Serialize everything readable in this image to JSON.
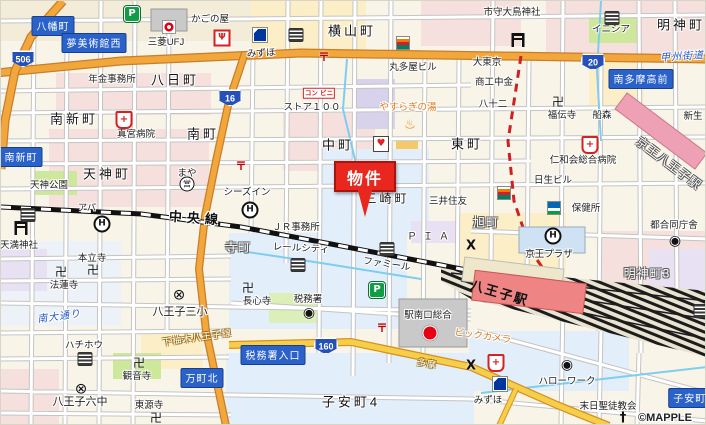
{
  "map": {
    "marker": {
      "label": "物件"
    },
    "copyright": "©MAPPLE",
    "colors": {
      "road_major": "#f2a73d",
      "road_secondary": "#f6cf4a",
      "sign_bg": "#2b62c9",
      "marker_red": "#e8281e",
      "rail_black": "#111111",
      "station_pink": "#ee8484",
      "water": "#7ecdf0"
    },
    "shields": [
      {
        "n": "route-shield-506",
        "route": "506",
        "x": 22,
        "y": 58
      },
      {
        "n": "route-shield-16",
        "route": "16",
        "x": 229,
        "y": 97
      },
      {
        "n": "route-shield-20",
        "route": "20",
        "x": 592,
        "y": 61
      },
      {
        "n": "route-shield-160",
        "route": "160",
        "x": 325,
        "y": 345
      }
    ],
    "labels": [
      {
        "n": "sign-hachimancho",
        "text": "八幡町",
        "x": 52,
        "y": 25,
        "cls": "sign"
      },
      {
        "n": "sign-yume-bijutsukan-nishi",
        "text": "夢美術館西",
        "x": 93,
        "y": 42,
        "cls": "sign"
      },
      {
        "n": "sign-minami-shincho",
        "text": "南新町",
        "x": 20,
        "y": 156,
        "cls": "sign"
      },
      {
        "n": "sign-minami-tama-ko-mae",
        "text": "南多摩高前",
        "x": 640,
        "y": 78,
        "cls": "sign"
      },
      {
        "n": "sign-mancho-kita",
        "text": "万町北",
        "x": 201,
        "y": 377,
        "cls": "sign"
      },
      {
        "n": "sign-zeimusho-iriguchi",
        "text": "税務署入口",
        "x": 272,
        "y": 354,
        "cls": "sign"
      },
      {
        "n": "sign-koyasucho",
        "text": "子安町4",
        "x": 692,
        "y": 397,
        "cls": "sign"
      },
      {
        "n": "town-yokamachi",
        "text": "八日町",
        "x": 174,
        "y": 78,
        "cls": "town"
      },
      {
        "n": "town-yokoyamacho",
        "text": "横山町",
        "x": 351,
        "y": 29,
        "cls": "town"
      },
      {
        "n": "town-myojincho",
        "text": "明神町",
        "x": 680,
        "y": 23,
        "cls": "town"
      },
      {
        "n": "town-minami-shincho",
        "text": "南新町",
        "x": 73,
        "y": 117,
        "cls": "town"
      },
      {
        "n": "town-minamicho",
        "text": "南町",
        "x": 202,
        "y": 132,
        "cls": "town"
      },
      {
        "n": "town-nakacho",
        "text": "中町",
        "x": 337,
        "y": 143,
        "cls": "town"
      },
      {
        "n": "town-higashicho",
        "text": "東町",
        "x": 466,
        "y": 142,
        "cls": "town"
      },
      {
        "n": "town-tenjincho",
        "text": "天神町",
        "x": 106,
        "y": 172,
        "cls": "town"
      },
      {
        "n": "town-misakicho",
        "text": "三崎町",
        "x": 386,
        "y": 197,
        "cls": "town",
        "fs": 12
      },
      {
        "n": "town-koyasucho-4",
        "text": "子安町4",
        "x": 350,
        "y": 400,
        "cls": "town"
      },
      {
        "n": "town-teramachi",
        "text": "寺町",
        "x": 237,
        "y": 246,
        "cls": "town-rev"
      },
      {
        "n": "town-asahicho",
        "text": "旭町",
        "x": 485,
        "y": 221,
        "cls": "town-rev"
      },
      {
        "n": "town-myojincho-3",
        "text": "明神町3",
        "x": 646,
        "y": 272,
        "cls": "town-rev"
      },
      {
        "n": "label-keio-hachioji-station",
        "text": "京王八王子駅",
        "x": 668,
        "y": 162,
        "cls": "town-rev",
        "rot": 37
      },
      {
        "n": "road-koshu-kaido",
        "text": "甲州街道",
        "x": 681,
        "y": 54,
        "cls": "roadblue",
        "rot": -4
      },
      {
        "n": "road-minami-odori",
        "text": "南大通り",
        "x": 58,
        "y": 314,
        "cls": "roadblue",
        "rot": -8
      },
      {
        "n": "rail-chuo-line",
        "text": "中央線",
        "x": 195,
        "y": 216,
        "cls": "rail",
        "rot": 4
      },
      {
        "n": "road-tama",
        "text": "多摩",
        "x": 426,
        "y": 362,
        "cls": "onroad",
        "rot": 10
      },
      {
        "n": "road-shimoyugi-hachioji-line",
        "text": "下柚木八王子線",
        "x": 196,
        "y": 336,
        "cls": "onroad",
        "rot": -8
      },
      {
        "n": "poi-kagonoya",
        "text": "かごの屋",
        "x": 209,
        "y": 17,
        "cls": "poi"
      },
      {
        "n": "poi-mufg-bank",
        "text": "三菱UFJ",
        "x": 165,
        "y": 40,
        "cls": "poi"
      },
      {
        "n": "poi-mizuho-north",
        "text": "みずほ",
        "x": 260,
        "y": 51,
        "cls": "poi",
        "rot": -3
      },
      {
        "n": "poi-nenkin-jimusho",
        "text": "年金事務所",
        "x": 111,
        "y": 77,
        "cls": "poi"
      },
      {
        "n": "poi-shingu-hospital",
        "text": "真宮病院",
        "x": 135,
        "y": 132,
        "cls": "poi"
      },
      {
        "n": "poi-marutaya-bldg",
        "text": "丸多屋ビル",
        "x": 412,
        "y": 65,
        "cls": "poi"
      },
      {
        "n": "poi-dai-tokyo",
        "text": "大東京",
        "x": 486,
        "y": 60,
        "cls": "poi"
      },
      {
        "n": "poi-shoko-chukin",
        "text": "商工中金",
        "x": 493,
        "y": 80,
        "cls": "poi"
      },
      {
        "n": "poi-hachijuni-bank",
        "text": "八十二",
        "x": 492,
        "y": 102,
        "cls": "poi"
      },
      {
        "n": "poi-ichimori-otori-shrine",
        "text": "市守大鳥神社",
        "x": 511,
        "y": 10,
        "cls": "poi"
      },
      {
        "n": "poi-inicia",
        "text": "イニシア",
        "x": 610,
        "y": 27,
        "cls": "poi"
      },
      {
        "n": "poi-fukudenji",
        "text": "福伝寺",
        "x": 561,
        "y": 113,
        "cls": "poi"
      },
      {
        "n": "poi-funamori",
        "text": "船森",
        "x": 601,
        "y": 113,
        "cls": "poi"
      },
      {
        "n": "poi-shinsei",
        "text": "新生",
        "x": 692,
        "y": 114,
        "cls": "poi"
      },
      {
        "n": "poi-store-100",
        "text": "ストア１００",
        "x": 311,
        "y": 105,
        "cls": "poi"
      },
      {
        "n": "poi-yasuragi-no-yu",
        "text": "やすらぎの湯",
        "x": 407,
        "y": 105,
        "cls": "orange"
      },
      {
        "n": "poi-ninnakai-hospital",
        "text": "仁和会総合病院",
        "x": 582,
        "y": 158,
        "cls": "poi"
      },
      {
        "n": "poi-nissei-bldg",
        "text": "日生ビル",
        "x": 552,
        "y": 178,
        "cls": "poi"
      },
      {
        "n": "poi-hokenjo",
        "text": "保健所",
        "x": 585,
        "y": 206,
        "cls": "poi"
      },
      {
        "n": "poi-to-godo-chosha",
        "text": "都合同庁舎",
        "x": 673,
        "y": 223,
        "cls": "poi"
      },
      {
        "n": "poi-keio-plaza",
        "text": "京王プラザ",
        "x": 548,
        "y": 252,
        "cls": "poi"
      },
      {
        "n": "poi-smbc",
        "text": "三井住友",
        "x": 447,
        "y": 199,
        "cls": "poi"
      },
      {
        "n": "poi-seas-inn",
        "text": "シーズイン",
        "x": 246,
        "y": 190,
        "cls": "poi"
      },
      {
        "n": "poi-jr-jimusho",
        "text": "ＪＲ事務所",
        "x": 295,
        "y": 225,
        "cls": "poi"
      },
      {
        "n": "poi-rail-city",
        "text": "レールシティ",
        "x": 300,
        "y": 246,
        "cls": "poi",
        "rot": 3
      },
      {
        "n": "poi-famille",
        "text": "ファミール",
        "x": 386,
        "y": 262,
        "cls": "poi",
        "rot": 8
      },
      {
        "n": "poi-tenjin-park",
        "text": "天神公園",
        "x": 48,
        "y": 183,
        "cls": "poi"
      },
      {
        "n": "poi-maya",
        "text": "まや",
        "x": 186,
        "y": 171,
        "cls": "poi"
      },
      {
        "n": "poi-temma-shrine",
        "text": "天満神社",
        "x": 18,
        "y": 243,
        "cls": "poi"
      },
      {
        "n": "poi-honryuji",
        "text": "本立寺",
        "x": 91,
        "y": 256,
        "cls": "poi"
      },
      {
        "n": "poi-horenji",
        "text": "法蓮寺",
        "x": 63,
        "y": 283,
        "cls": "poi"
      },
      {
        "n": "poi-apa",
        "text": "アパ",
        "x": 86,
        "y": 206,
        "cls": "poi",
        "fs": 9
      },
      {
        "n": "poi-hachioji-3rd-elementary",
        "text": "八王子三小",
        "x": 179,
        "y": 310,
        "cls": "poi",
        "fs": 11
      },
      {
        "n": "poi-hachiho",
        "text": "ハチホウ",
        "x": 83,
        "y": 343,
        "cls": "poi"
      },
      {
        "n": "poi-kannonji",
        "text": "観音寺",
        "x": 136,
        "y": 374,
        "cls": "poi"
      },
      {
        "n": "poi-hachioji-6th-jhs",
        "text": "八王子六中",
        "x": 79,
        "y": 400,
        "cls": "poi",
        "fs": 11
      },
      {
        "n": "poi-togenji",
        "text": "東源寺",
        "x": 148,
        "y": 403,
        "cls": "poi"
      },
      {
        "n": "poi-choshinji",
        "text": "長心寺",
        "x": 256,
        "y": 299,
        "cls": "poi"
      },
      {
        "n": "poi-zeimusho",
        "text": "税務署",
        "x": 307,
        "y": 297,
        "cls": "poi"
      },
      {
        "n": "poi-eki-minamiguchi-sogo",
        "text": "駅南口総合",
        "x": 427,
        "y": 313,
        "cls": "poi"
      },
      {
        "n": "poi-bic-camera",
        "text": "ビックカメラ",
        "x": 482,
        "y": 334,
        "cls": "orange",
        "rot": 8
      },
      {
        "n": "poi-hachioji-station",
        "text": "八王子駅",
        "x": 499,
        "y": 291,
        "cls": "station",
        "rot": 16
      },
      {
        "n": "poi-hello-work",
        "text": "ハローワーク",
        "x": 566,
        "y": 379,
        "cls": "poi"
      },
      {
        "n": "poi-matsujitsu-seito-church",
        "text": "末日聖徒教会",
        "x": 607,
        "y": 404,
        "cls": "poi"
      },
      {
        "n": "poi-mizuho-south",
        "text": "みずほ",
        "x": 487,
        "y": 398,
        "cls": "poi"
      },
      {
        "n": "poi-pia",
        "text": "ＰＩＡ",
        "x": 430,
        "y": 234,
        "cls": "pia"
      },
      {
        "n": "map-copyright",
        "text": "©MAPPLE",
        "x": 664,
        "y": 417,
        "cls": "copyright"
      }
    ],
    "icons": [
      {
        "n": "parking-icon",
        "t": "parking",
        "x": 131,
        "y": 13,
        "g": "P"
      },
      {
        "n": "parking-icon",
        "t": "parking",
        "x": 376,
        "y": 289,
        "g": "P"
      },
      {
        "n": "hospital-icon",
        "t": "hospital",
        "x": 123,
        "y": 119,
        "g": "+"
      },
      {
        "n": "hospital-icon",
        "t": "hospital",
        "x": 589,
        "y": 144,
        "g": "+"
      },
      {
        "n": "hospital-icon",
        "t": "hospital",
        "x": 495,
        "y": 362,
        "g": "+"
      },
      {
        "n": "temple-icon",
        "t": "temple",
        "x": 60,
        "y": 271,
        "g": "卍"
      },
      {
        "n": "temple-icon",
        "t": "temple",
        "x": 92,
        "y": 269,
        "g": "卍"
      },
      {
        "n": "temple-icon",
        "t": "temple",
        "x": 138,
        "y": 362,
        "g": "卍"
      },
      {
        "n": "temple-icon",
        "t": "temple",
        "x": 155,
        "y": 417,
        "g": "卍"
      },
      {
        "n": "temple-icon",
        "t": "temple",
        "x": 247,
        "y": 287,
        "g": "卍"
      },
      {
        "n": "temple-icon",
        "t": "temple",
        "x": 557,
        "y": 101,
        "g": "卍"
      },
      {
        "n": "torii-icon",
        "t": "torii",
        "x": 20,
        "y": 227
      },
      {
        "n": "torii-icon",
        "t": "torii",
        "x": 517,
        "y": 25
      },
      {
        "n": "school-icon",
        "t": "school",
        "x": 178,
        "y": 294,
        "g": "⊗"
      },
      {
        "n": "school-icon",
        "t": "school",
        "x": 80,
        "y": 388,
        "g": "⊗"
      },
      {
        "n": "hotel-icon",
        "t": "hotel",
        "x": 101,
        "y": 223,
        "g": "H"
      },
      {
        "n": "hotel-icon",
        "t": "hotel",
        "x": 249,
        "y": 209,
        "g": "H"
      },
      {
        "n": "hotel-icon",
        "t": "hotel",
        "x": 552,
        "y": 235,
        "g": "H"
      },
      {
        "n": "post-office-icon",
        "t": "post",
        "x": 323,
        "y": 56,
        "g": "〒"
      },
      {
        "n": "post-office-icon",
        "t": "post",
        "x": 240,
        "y": 165,
        "g": "〒"
      },
      {
        "n": "post-office-icon",
        "t": "post",
        "x": 381,
        "y": 327,
        "g": "〒"
      },
      {
        "n": "police-box-icon",
        "t": "police",
        "x": 470,
        "y": 245,
        "g": "X"
      },
      {
        "n": "police-box-icon",
        "t": "police",
        "x": 470,
        "y": 365,
        "g": "X"
      },
      {
        "n": "heart-icon",
        "t": "heart",
        "x": 380,
        "y": 143,
        "g": "♥"
      },
      {
        "n": "bank-icon",
        "t": "bank",
        "x": 27,
        "y": 214
      },
      {
        "n": "bank-icon",
        "t": "bank",
        "x": 295,
        "y": 34
      },
      {
        "n": "bank-icon",
        "t": "bank",
        "x": 386,
        "y": 248
      },
      {
        "n": "bank-icon",
        "t": "bank",
        "x": 297,
        "y": 264
      },
      {
        "n": "bank-icon",
        "t": "bank",
        "x": 84,
        "y": 358
      },
      {
        "n": "bank-icon",
        "t": "bank",
        "x": 611,
        "y": 17
      },
      {
        "n": "bank-icon",
        "t": "bank",
        "x": 700,
        "y": 310
      },
      {
        "n": "gov-office-icon",
        "t": "gov",
        "x": 308,
        "y": 312,
        "g": "◉"
      },
      {
        "n": "gov-office-icon",
        "t": "gov",
        "x": 566,
        "y": 364,
        "g": "◉"
      },
      {
        "n": "gov-office-icon",
        "t": "gov",
        "x": 674,
        "y": 240,
        "g": "◉"
      },
      {
        "n": "bus-office-icon",
        "t": "ei",
        "x": 186,
        "y": 183,
        "g": "営"
      },
      {
        "n": "bic-camera-icon",
        "t": "bic",
        "x": 429,
        "y": 332
      },
      {
        "n": "onsen-icon",
        "t": "onsen",
        "x": 409,
        "y": 124,
        "g": "♨"
      },
      {
        "n": "convenience-icon",
        "t": "conbini",
        "x": 318,
        "y": 92,
        "g": "コン\nビニ"
      },
      {
        "n": "church-icon",
        "t": "church",
        "x": 622,
        "y": 417,
        "g": "†"
      },
      {
        "n": "restaurant-icon",
        "t": "restaurant",
        "x": 221,
        "y": 37,
        "g": "Ψ"
      },
      {
        "n": "seven-eleven-icon",
        "t": "seven",
        "x": 402,
        "y": 42
      },
      {
        "n": "seven-eleven-icon",
        "t": "seven",
        "x": 503,
        "y": 192
      },
      {
        "n": "family-mart-icon",
        "t": "famima",
        "x": 553,
        "y": 207
      },
      {
        "n": "mufg-logo-icon",
        "t": "mufg",
        "x": 168,
        "y": 26
      },
      {
        "n": "mizuho-logo-icon",
        "t": "mizuho",
        "x": 259,
        "y": 34
      },
      {
        "n": "mizuho-logo-icon",
        "t": "mizuho",
        "x": 499,
        "y": 383
      }
    ]
  }
}
